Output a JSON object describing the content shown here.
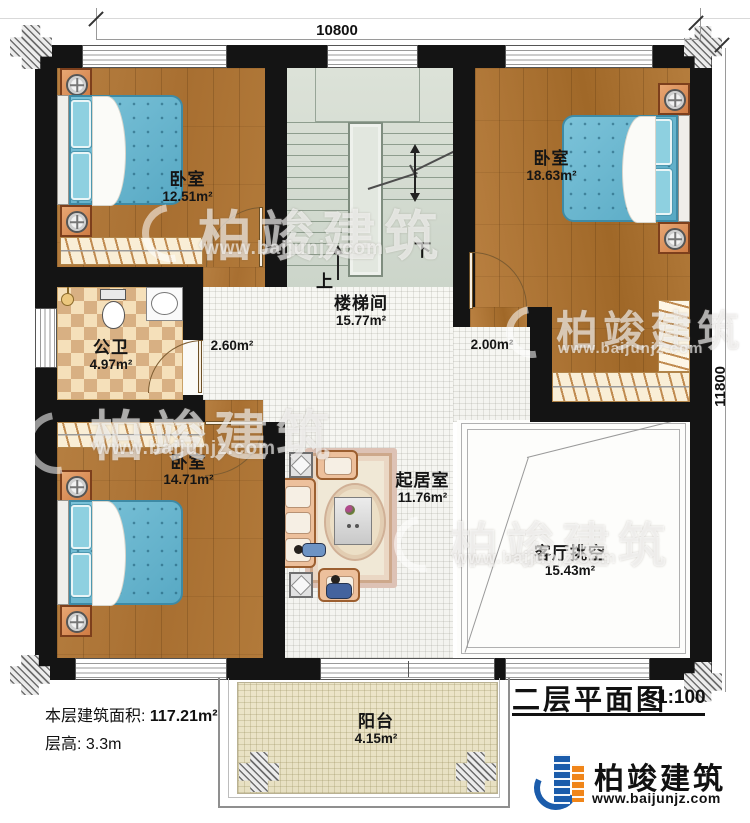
{
  "dimensions": {
    "top": "10800",
    "right": "11800"
  },
  "rooms": [
    {
      "name": "卧室",
      "area": "12.51m²"
    },
    {
      "name": "卧室",
      "area": "18.63m²"
    },
    {
      "name": "公卫",
      "area": "4.97m²"
    },
    {
      "name": "楼梯间",
      "area": "15.77m²"
    },
    {
      "name": "卧室",
      "area": "14.71m²"
    },
    {
      "name": "起居室",
      "area": "11.76m²"
    },
    {
      "name": "客厅挑空",
      "area": "15.43m²"
    },
    {
      "name": "阳台",
      "area": "4.15m²"
    }
  ],
  "halls": {
    "left": "2.60m²",
    "right": "2.00m²"
  },
  "stairs": {
    "up": "上",
    "down": "下"
  },
  "info": {
    "area_label": "本层建筑面积:",
    "area_value": "117.21m²",
    "height_label": "层高:",
    "height_value": "3.3m"
  },
  "title_block": {
    "title": "二层平面图",
    "scale": "1:100"
  },
  "branding": {
    "company": "柏竣建筑",
    "website": "www.baijunjz.com",
    "blue": "#1b5cab",
    "orange": "#f08519"
  }
}
